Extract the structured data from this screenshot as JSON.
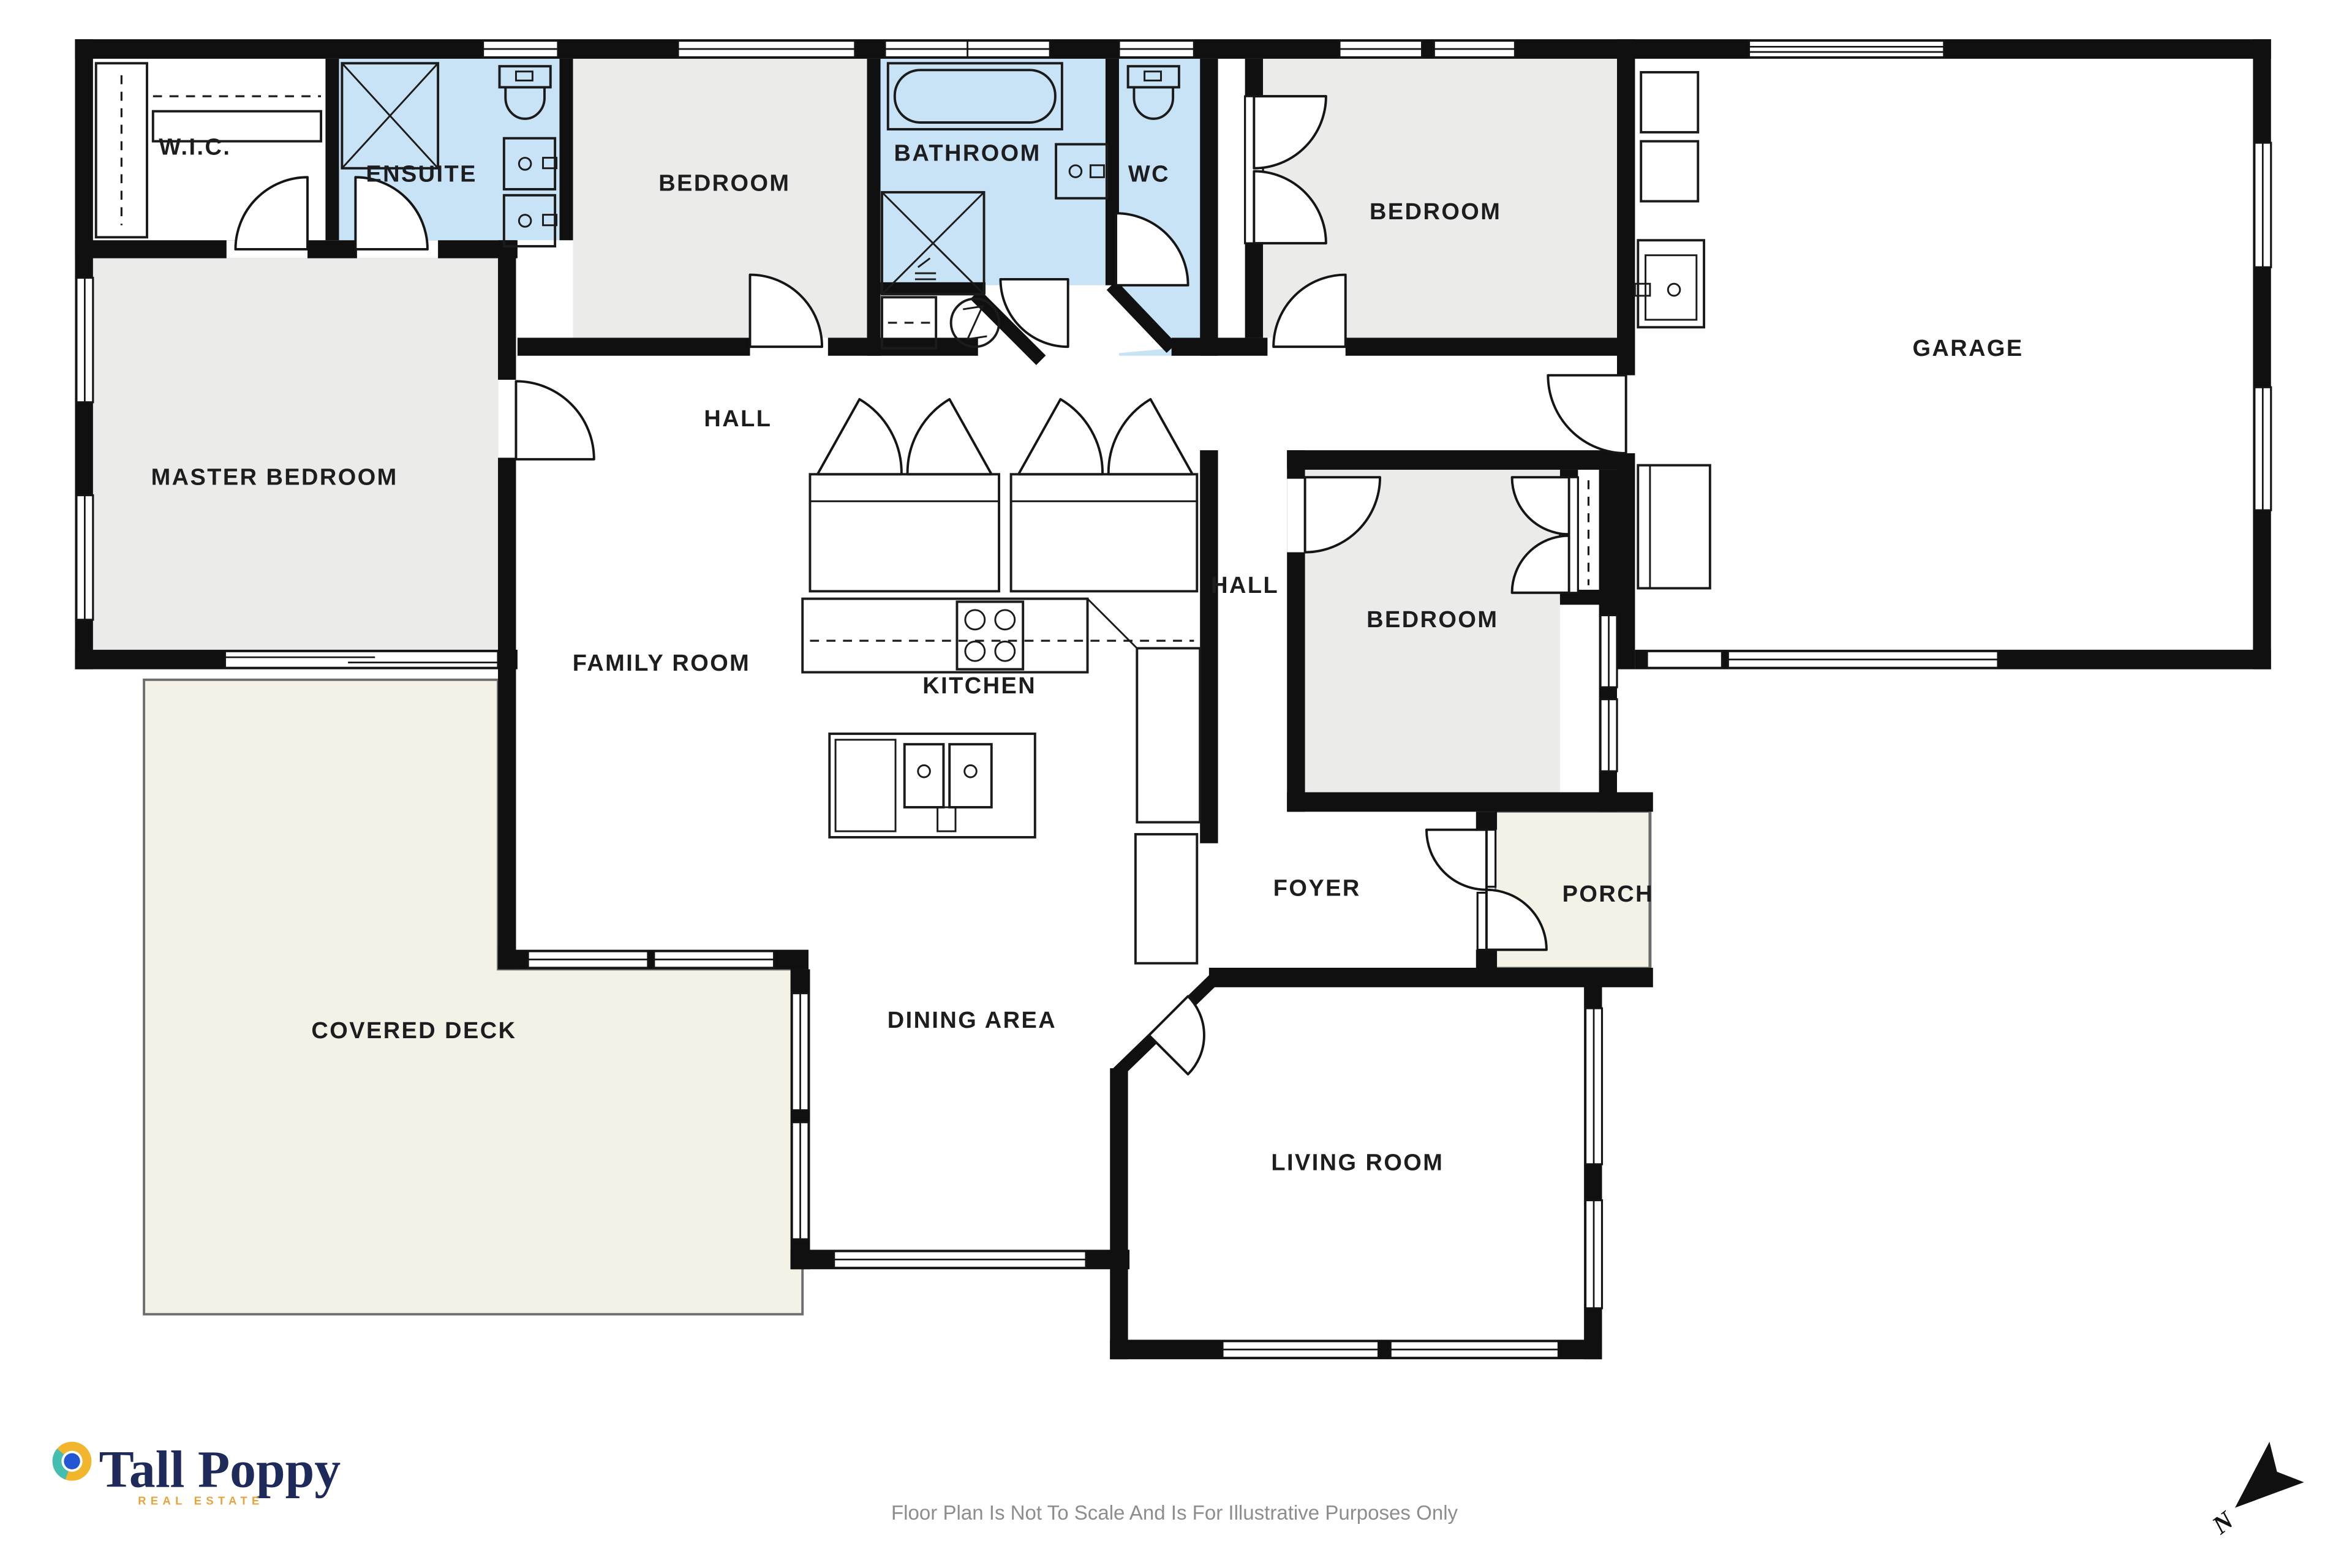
{
  "plan": {
    "rooms": {
      "wic": {
        "label": "W.I.C."
      },
      "ensuite": {
        "label": "ENSUITE"
      },
      "bedroom_top": {
        "label": "BEDROOM"
      },
      "bathroom": {
        "label": "BATHROOM"
      },
      "wc": {
        "label": "WC"
      },
      "bedroom_right": {
        "label": "BEDROOM"
      },
      "garage": {
        "label": "GARAGE"
      },
      "master_bedroom": {
        "label": "MASTER BEDROOM"
      },
      "hall_north": {
        "label": "HALL"
      },
      "hall_east": {
        "label": "HALL"
      },
      "bedroom_middle": {
        "label": "BEDROOM"
      },
      "family_room": {
        "label": "FAMILY ROOM"
      },
      "kitchen": {
        "label": "KITCHEN"
      },
      "covered_deck": {
        "label": "COVERED DECK"
      },
      "dining_area": {
        "label": "DINING AREA"
      },
      "foyer": {
        "label": "FOYER"
      },
      "porch": {
        "label": "PORCH"
      },
      "living_room": {
        "label": "LIVING ROOM"
      }
    },
    "compass": {
      "label": "N"
    },
    "colors": {
      "wall": "#101010",
      "wet_room_fill": "#c8e2f6",
      "bedroom_fill": "#ebebe9",
      "outdoor_fill": "#f4f2e6"
    }
  },
  "branding": {
    "name": "Tall Poppy",
    "tagline": "REAL ESTATE",
    "icon_colors": {
      "ring_yellow": "#f2b52e",
      "ring_teal": "#45bdb0",
      "center_blue": "#2256d2",
      "navy": "#1e2a5a"
    }
  },
  "footer": {
    "disclaimer": "Floor Plan Is Not To Scale And Is For Illustrative Purposes Only"
  }
}
